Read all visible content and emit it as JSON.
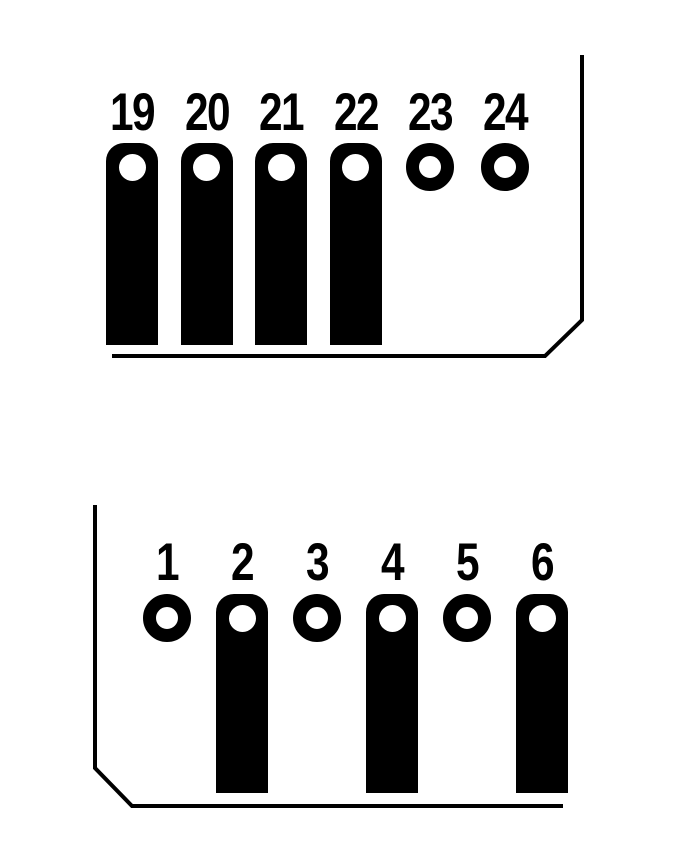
{
  "diagram": {
    "background_color": "#ffffff",
    "ink_color": "#000000",
    "connectors": [
      {
        "id": "upper-connector",
        "pins": [
          {
            "label": "19",
            "type": "bar"
          },
          {
            "label": "20",
            "type": "bar"
          },
          {
            "label": "21",
            "type": "bar"
          },
          {
            "label": "22",
            "type": "bar"
          },
          {
            "label": "23",
            "type": "ring"
          },
          {
            "label": "24",
            "type": "ring"
          }
        ]
      },
      {
        "id": "lower-connector",
        "pins": [
          {
            "label": "1",
            "type": "ring"
          },
          {
            "label": "2",
            "type": "bar"
          },
          {
            "label": "3",
            "type": "ring"
          },
          {
            "label": "4",
            "type": "bar"
          },
          {
            "label": "5",
            "type": "ring"
          },
          {
            "label": "6",
            "type": "bar"
          }
        ]
      }
    ]
  }
}
